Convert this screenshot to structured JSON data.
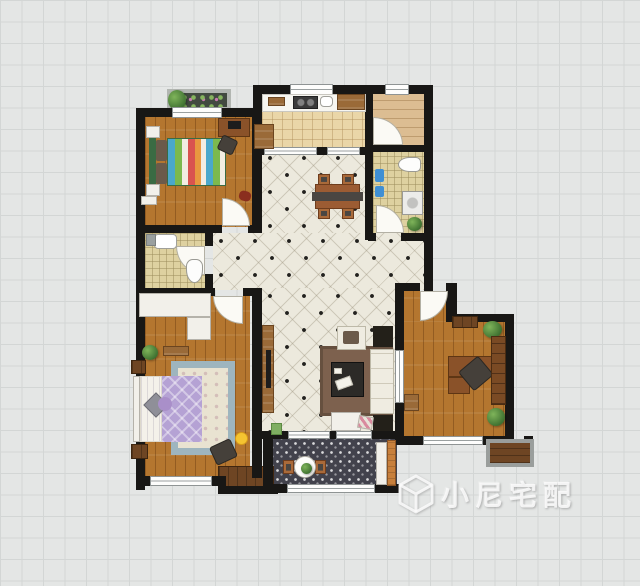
{
  "canvas": {
    "width": 640,
    "height": 586,
    "background": "#e4e6e5",
    "grid_color": "#d3d6d5"
  },
  "watermark": {
    "icon": "cube-logo-icon",
    "text": "小尼宅配"
  },
  "palette": {
    "wall": "#181715",
    "oak_floor": "#b4762f",
    "light_plank": "#dcbd92",
    "tile": "#ece9dd",
    "kitchen_tile": "#ead6a8",
    "mosaic": "#ded1a0",
    "balcony_tile": "#42424c",
    "purple_quilt": "#b5a2d4",
    "stripe_blue": "#4aa8cc",
    "stripe_green": "#7cb94e",
    "stripe_red": "#d9534f",
    "rug_blue": "#9eb5be",
    "rug_brown": "#7d614e",
    "smiley_yellow": "#f5c431",
    "towel_blue": "#3f8fd4",
    "door_orange": "#c8803c"
  },
  "elements": [
    {
      "n": "bedroom2-floor",
      "k": "floor-oak",
      "x": 145,
      "y": 116,
      "w": 108,
      "h": 111
    },
    {
      "n": "kitchen-floor",
      "k": "floor-kitchen",
      "x": 262,
      "y": 93,
      "w": 103,
      "h": 57
    },
    {
      "n": "foyer-floor",
      "k": "floor-oak-h",
      "x": 373,
      "y": 93,
      "w": 51,
      "h": 53
    },
    {
      "n": "bathroom1-floor",
      "k": "floor-mosaic",
      "x": 373,
      "y": 152,
      "w": 51,
      "h": 82
    },
    {
      "n": "dining-floor",
      "k": "floor-tile",
      "x": 262,
      "y": 150,
      "w": 103,
      "h": 85
    },
    {
      "n": "hallway-floor",
      "k": "floor-tile",
      "x": 213,
      "y": 233,
      "w": 211,
      "h": 57
    },
    {
      "n": "living-floor",
      "k": "floor-tile",
      "x": 262,
      "y": 288,
      "w": 133,
      "h": 146
    },
    {
      "n": "bathroom2-floor",
      "k": "floor-mosaic",
      "x": 145,
      "y": 233,
      "w": 60,
      "h": 57
    },
    {
      "n": "master-bedroom-floor",
      "k": "floor-oak",
      "x": 145,
      "y": 296,
      "w": 105,
      "h": 184
    },
    {
      "n": "study-floor-upper",
      "k": "floor-oak",
      "x": 403,
      "y": 291,
      "w": 46,
      "h": 32
    },
    {
      "n": "study-floor",
      "k": "floor-oak",
      "x": 403,
      "y": 322,
      "w": 102,
      "h": 116
    },
    {
      "n": "balcony-floor",
      "k": "floor-balcony",
      "x": 273,
      "y": 439,
      "w": 124,
      "h": 47
    },
    {
      "n": "bay-cabinet",
      "k": "cab-dark",
      "x": 218,
      "y": 466,
      "w": 56,
      "h": 24
    },
    {
      "n": "flower-box",
      "k": "planter",
      "x": 167,
      "y": 89,
      "w": 64,
      "h": 22
    },
    {
      "n": "plant",
      "k": "plant",
      "x": 168,
      "y": 90,
      "w": 18,
      "h": 20
    },
    {
      "n": "wall",
      "k": "wall",
      "x": 136,
      "y": 108,
      "w": 126,
      "h": 9
    },
    {
      "n": "wall",
      "k": "wall",
      "x": 253,
      "y": 85,
      "w": 9,
      "h": 70
    },
    {
      "n": "wall",
      "k": "wall",
      "x": 262,
      "y": 85,
      "w": 171,
      "h": 9
    },
    {
      "n": "wall",
      "k": "wall",
      "x": 136,
      "y": 108,
      "w": 9,
      "h": 382
    },
    {
      "n": "wall",
      "k": "wall",
      "x": 252,
      "y": 117,
      "w": 10,
      "h": 116
    },
    {
      "n": "wall",
      "k": "wall",
      "x": 365,
      "y": 94,
      "w": 8,
      "h": 146
    },
    {
      "n": "wall",
      "k": "wall",
      "x": 424,
      "y": 94,
      "w": 9,
      "h": 197
    },
    {
      "n": "wall",
      "k": "wall",
      "x": 368,
      "y": 145,
      "w": 57,
      "h": 7
    },
    {
      "n": "wall",
      "k": "wall",
      "x": 368,
      "y": 233,
      "w": 8,
      "h": 8
    },
    {
      "n": "wall",
      "k": "wall",
      "x": 401,
      "y": 233,
      "w": 24,
      "h": 8
    },
    {
      "n": "wall",
      "k": "wall",
      "x": 136,
      "y": 225,
      "w": 86,
      "h": 8
    },
    {
      "n": "wall",
      "k": "wall",
      "x": 248,
      "y": 225,
      "w": 14,
      "h": 8
    },
    {
      "n": "wall",
      "k": "wall",
      "x": 205,
      "y": 233,
      "w": 8,
      "h": 13
    },
    {
      "n": "wall",
      "k": "wall",
      "x": 205,
      "y": 274,
      "w": 8,
      "h": 17
    },
    {
      "n": "wall",
      "k": "wall",
      "x": 136,
      "y": 288,
      "w": 79,
      "h": 8
    },
    {
      "n": "wall",
      "k": "wall",
      "x": 243,
      "y": 288,
      "w": 19,
      "h": 8
    },
    {
      "n": "wall",
      "k": "wall",
      "x": 252,
      "y": 296,
      "w": 10,
      "h": 182
    },
    {
      "n": "wall",
      "k": "wall",
      "x": 136,
      "y": 476,
      "w": 90,
      "h": 10
    },
    {
      "n": "wall",
      "k": "wall",
      "x": 218,
      "y": 486,
      "w": 60,
      "h": 8
    },
    {
      "n": "wall",
      "k": "wall",
      "x": 262,
      "y": 431,
      "w": 135,
      "h": 8
    },
    {
      "n": "wall",
      "k": "wall",
      "x": 263,
      "y": 431,
      "w": 10,
      "h": 62
    },
    {
      "n": "wall",
      "k": "wall",
      "x": 273,
      "y": 484,
      "w": 126,
      "h": 9
    },
    {
      "n": "wall",
      "k": "wall",
      "x": 395,
      "y": 283,
      "w": 9,
      "h": 162
    },
    {
      "n": "wall",
      "k": "wall",
      "x": 404,
      "y": 283,
      "w": 16,
      "h": 8
    },
    {
      "n": "wall",
      "k": "wall",
      "x": 446,
      "y": 283,
      "w": 11,
      "h": 39
    },
    {
      "n": "wall",
      "k": "wall",
      "x": 453,
      "y": 314,
      "w": 58,
      "h": 8
    },
    {
      "n": "wall",
      "k": "wall",
      "x": 505,
      "y": 314,
      "w": 9,
      "h": 131
    },
    {
      "n": "wall",
      "k": "wall",
      "x": 395,
      "y": 436,
      "w": 119,
      "h": 9
    },
    {
      "n": "wall",
      "k": "wall",
      "x": 253,
      "y": 147,
      "w": 11,
      "h": 8
    },
    {
      "n": "wall",
      "k": "wall",
      "x": 317,
      "y": 147,
      "w": 10,
      "h": 8
    },
    {
      "n": "wall",
      "k": "wall",
      "x": 360,
      "y": 147,
      "w": 13,
      "h": 8
    },
    {
      "n": "wall",
      "k": "wall",
      "x": 486,
      "y": 436,
      "w": 9,
      "h": 10
    },
    {
      "n": "wall",
      "k": "wall",
      "x": 524,
      "y": 436,
      "w": 9,
      "h": 10
    },
    {
      "n": "window",
      "k": "win-h",
      "x": 172,
      "y": 107,
      "w": 50,
      "h": 11
    },
    {
      "n": "window",
      "k": "win-h",
      "x": 290,
      "y": 84,
      "w": 43,
      "h": 11
    },
    {
      "n": "window",
      "k": "win-h",
      "x": 385,
      "y": 84,
      "w": 24,
      "h": 11
    },
    {
      "n": "window",
      "k": "win-h",
      "x": 264,
      "y": 147,
      "w": 53,
      "h": 8
    },
    {
      "n": "window",
      "k": "win-h",
      "x": 327,
      "y": 147,
      "w": 33,
      "h": 8
    },
    {
      "n": "window",
      "k": "win-h",
      "x": 150,
      "y": 476,
      "w": 62,
      "h": 10
    },
    {
      "n": "window",
      "k": "win-h",
      "x": 287,
      "y": 484,
      "w": 88,
      "h": 9
    },
    {
      "n": "window",
      "k": "win-h",
      "x": 288,
      "y": 431,
      "w": 42,
      "h": 8
    },
    {
      "n": "window",
      "k": "win-h",
      "x": 336,
      "y": 431,
      "w": 36,
      "h": 8
    },
    {
      "n": "window",
      "k": "win-v",
      "x": 395,
      "y": 350,
      "w": 9,
      "h": 53
    },
    {
      "n": "window",
      "k": "win-h",
      "x": 423,
      "y": 436,
      "w": 60,
      "h": 9
    },
    {
      "n": "door-swing",
      "k": "arc-ne",
      "x": 222,
      "y": 198,
      "w": 28,
      "h": 28
    },
    {
      "n": "door-swing",
      "k": "arc-sw",
      "x": 176,
      "y": 246,
      "w": 29,
      "h": 29
    },
    {
      "n": "door-swing",
      "k": "arc-sw",
      "x": 213,
      "y": 296,
      "w": 30,
      "h": 28
    },
    {
      "n": "door-swing",
      "k": "arc-ne",
      "x": 373,
      "y": 117,
      "w": 30,
      "h": 28
    },
    {
      "n": "door-swing",
      "k": "arc-ne",
      "x": 376,
      "y": 205,
      "w": 28,
      "h": 28
    },
    {
      "n": "door-swing",
      "k": "arc-se",
      "x": 420,
      "y": 291,
      "w": 28,
      "h": 30
    },
    {
      "n": "kitchen-counter",
      "k": "counter",
      "x": 262,
      "y": 94,
      "w": 104,
      "h": 18
    },
    {
      "n": "cutting-board",
      "k": "cab-wood",
      "x": 268,
      "y": 97,
      "w": 17,
      "h": 9
    },
    {
      "n": "stove",
      "k": "appl-dark",
      "x": 293,
      "y": 96,
      "w": 25,
      "h": 13
    },
    {
      "n": "kitchen-sink",
      "k": "sink",
      "x": 320,
      "y": 96,
      "w": 13,
      "h": 11
    },
    {
      "n": "kitchen-cabinet",
      "k": "cab-wood",
      "x": 337,
      "y": 94,
      "w": 28,
      "h": 16
    },
    {
      "n": "fridge",
      "k": "cab-wood",
      "x": 254,
      "y": 124,
      "w": 20,
      "h": 25
    },
    {
      "n": "toilet",
      "k": "toilet",
      "x": 398,
      "y": 157,
      "w": 23,
      "h": 15
    },
    {
      "n": "towel",
      "k": "towel",
      "x": 375,
      "y": 169,
      "w": 9,
      "h": 13
    },
    {
      "n": "towel",
      "k": "towel",
      "x": 375,
      "y": 186,
      "w": 9,
      "h": 11
    },
    {
      "n": "washing-machine",
      "k": "washer",
      "x": 402,
      "y": 191,
      "w": 21,
      "h": 24
    },
    {
      "n": "plant",
      "k": "plant",
      "x": 407,
      "y": 217,
      "w": 15,
      "h": 14
    },
    {
      "n": "dining-chair",
      "k": "chair-wood",
      "x": 318,
      "y": 174,
      "w": 12,
      "h": 11
    },
    {
      "n": "dining-chair",
      "k": "chair-wood",
      "x": 342,
      "y": 174,
      "w": 12,
      "h": 11
    },
    {
      "n": "dining-chair",
      "k": "chair-wood",
      "x": 318,
      "y": 208,
      "w": 12,
      "h": 11
    },
    {
      "n": "dining-chair",
      "k": "chair-wood",
      "x": 342,
      "y": 208,
      "w": 12,
      "h": 11
    },
    {
      "n": "dining-table",
      "k": "table-wood",
      "x": 315,
      "y": 184,
      "w": 45,
      "h": 25
    },
    {
      "n": "table-runner",
      "k": "runner",
      "x": 312,
      "y": 192,
      "w": 51,
      "h": 9
    },
    {
      "n": "bathroom-sink",
      "k": "sink",
      "x": 154,
      "y": 234,
      "w": 23,
      "h": 15
    },
    {
      "n": "toilet",
      "k": "toilet-v",
      "x": 186,
      "y": 259,
      "w": 17,
      "h": 24
    },
    {
      "n": "shower-fixture",
      "k": "gray-box",
      "x": 146,
      "y": 234,
      "w": 10,
      "h": 12
    },
    {
      "n": "wardrobe",
      "k": "white-box",
      "x": 139,
      "y": 293,
      "w": 72,
      "h": 24
    },
    {
      "n": "wardrobe",
      "k": "white-box",
      "x": 187,
      "y": 317,
      "w": 24,
      "h": 23
    },
    {
      "n": "bench",
      "k": "cab-wood",
      "x": 163,
      "y": 346,
      "w": 26,
      "h": 10
    },
    {
      "n": "plant",
      "k": "plant",
      "x": 142,
      "y": 345,
      "w": 16,
      "h": 15
    },
    {
      "n": "nightstand",
      "k": "cab-dark",
      "x": 131,
      "y": 360,
      "w": 15,
      "h": 14
    },
    {
      "n": "nightstand",
      "k": "cab-dark",
      "x": 131,
      "y": 444,
      "w": 17,
      "h": 15
    },
    {
      "n": "area-rug",
      "k": "rug-floral",
      "x": 171,
      "y": 361,
      "w": 64,
      "h": 94
    },
    {
      "n": "bed-headboard",
      "k": "white-box",
      "x": 133,
      "y": 376,
      "w": 7,
      "h": 66
    },
    {
      "n": "bed-sheet",
      "k": "sheet",
      "x": 140,
      "y": 376,
      "w": 22,
      "h": 66
    },
    {
      "n": "bed-quilt",
      "k": "quilt-purple",
      "x": 162,
      "y": 376,
      "w": 40,
      "h": 66
    },
    {
      "n": "pillow",
      "k": "pillow-gray",
      "x": 147,
      "y": 396,
      "w": 18,
      "h": 18,
      "r": 45
    },
    {
      "n": "pillow",
      "k": "pillow-purple",
      "x": 158,
      "y": 397,
      "w": 14,
      "h": 14
    },
    {
      "n": "smiley-rug",
      "k": "smiley",
      "x": 235,
      "y": 432,
      "w": 13,
      "h": 13
    },
    {
      "n": "armchair",
      "k": "chair-dark",
      "x": 212,
      "y": 442,
      "w": 23,
      "h": 20,
      "r": -25
    },
    {
      "n": "tv-cabinet",
      "k": "cab-wood",
      "x": 262,
      "y": 325,
      "w": 12,
      "h": 88
    },
    {
      "n": "tv",
      "k": "tv",
      "x": 266,
      "y": 350,
      "w": 5,
      "h": 38
    },
    {
      "n": "living-rug",
      "k": "rug-brown",
      "x": 320,
      "y": 346,
      "w": 73,
      "h": 70
    },
    {
      "n": "coffee-table",
      "k": "ctable",
      "x": 331,
      "y": 362,
      "w": 33,
      "h": 35
    },
    {
      "n": "magazine",
      "k": "paper",
      "x": 336,
      "y": 378,
      "w": 16,
      "h": 10,
      "r": -20
    },
    {
      "n": "remote",
      "k": "paper",
      "x": 334,
      "y": 368,
      "w": 8,
      "h": 6
    },
    {
      "n": "armchair",
      "k": "armchair",
      "x": 337,
      "y": 326,
      "w": 29,
      "h": 24
    },
    {
      "n": "armchair-cushion",
      "k": "cushion",
      "x": 343,
      "y": 331,
      "w": 16,
      "h": 13
    },
    {
      "n": "sofa",
      "k": "sofa",
      "x": 370,
      "y": 349,
      "w": 24,
      "h": 65
    },
    {
      "n": "side-table",
      "k": "sidetable",
      "x": 373,
      "y": 326,
      "w": 20,
      "h": 21
    },
    {
      "n": "side-table",
      "k": "sidetable",
      "x": 373,
      "y": 415,
      "w": 20,
      "h": 16
    },
    {
      "n": "console-table",
      "k": "white-box",
      "x": 331,
      "y": 412,
      "w": 30,
      "h": 19
    },
    {
      "n": "door-mat",
      "k": "mat-color",
      "x": 358,
      "y": 416,
      "w": 15,
      "h": 13,
      "r": 10
    },
    {
      "n": "door-mat",
      "k": "mat-green",
      "x": 271,
      "y": 423,
      "w": 11,
      "h": 12
    },
    {
      "n": "balcony-chair",
      "k": "chair-wood",
      "x": 283,
      "y": 460,
      "w": 11,
      "h": 14
    },
    {
      "n": "balcony-chair",
      "k": "chair-wood",
      "x": 315,
      "y": 460,
      "w": 11,
      "h": 14
    },
    {
      "n": "balcony-table",
      "k": "btable",
      "x": 294,
      "y": 456,
      "w": 22,
      "h": 22
    },
    {
      "n": "plant",
      "k": "plant",
      "x": 301,
      "y": 463,
      "w": 11,
      "h": 11
    },
    {
      "n": "balcony-cabinet",
      "k": "white-box",
      "x": 376,
      "y": 442,
      "w": 11,
      "h": 43
    },
    {
      "n": "balcony-door",
      "k": "door-orange",
      "x": 387,
      "y": 440,
      "w": 9,
      "h": 46
    },
    {
      "n": "wall-shelf",
      "k": "cab-dark",
      "x": 452,
      "y": 316,
      "w": 26,
      "h": 12
    },
    {
      "n": "plant",
      "k": "plant",
      "x": 483,
      "y": 321,
      "w": 19,
      "h": 17
    },
    {
      "n": "desk",
      "k": "desk-wood",
      "x": 448,
      "y": 356,
      "w": 49,
      "h": 21
    },
    {
      "n": "desk",
      "k": "desk-wood",
      "x": 448,
      "y": 377,
      "w": 22,
      "h": 17
    },
    {
      "n": "desk-chair",
      "k": "chair-dark",
      "x": 463,
      "y": 361,
      "w": 26,
      "h": 25,
      "r": -40
    },
    {
      "n": "bookshelf",
      "k": "bookshelf",
      "x": 491,
      "y": 336,
      "w": 15,
      "h": 69
    },
    {
      "n": "plant",
      "k": "plant",
      "x": 487,
      "y": 408,
      "w": 18,
      "h": 18
    },
    {
      "n": "cabinet",
      "k": "cab-wood",
      "x": 404,
      "y": 394,
      "w": 15,
      "h": 17
    },
    {
      "n": "flower-ledge",
      "k": "ledge",
      "x": 486,
      "y": 439,
      "w": 48,
      "h": 28
    },
    {
      "n": "bed-headboard",
      "k": "headboard-green",
      "x": 149,
      "y": 138,
      "w": 7,
      "h": 48
    },
    {
      "n": "pillow",
      "k": "cushion",
      "x": 156,
      "y": 140,
      "w": 11,
      "h": 21
    },
    {
      "n": "pillow",
      "k": "cushion",
      "x": 156,
      "y": 163,
      "w": 11,
      "h": 21
    },
    {
      "n": "bed-quilt",
      "k": "quilt-stripes",
      "x": 167,
      "y": 138,
      "w": 59,
      "h": 48
    },
    {
      "n": "nightstand",
      "k": "white-box",
      "x": 146,
      "y": 126,
      "w": 14,
      "h": 12
    },
    {
      "n": "nightstand",
      "k": "white-box",
      "x": 146,
      "y": 184,
      "w": 14,
      "h": 12
    },
    {
      "n": "desk",
      "k": "desk-wood",
      "x": 218,
      "y": 118,
      "w": 32,
      "h": 19
    },
    {
      "n": "monitor",
      "k": "tv",
      "x": 228,
      "y": 121,
      "w": 13,
      "h": 8
    },
    {
      "n": "desk-chair",
      "k": "chair-dark",
      "x": 219,
      "y": 137,
      "w": 17,
      "h": 16,
      "r": 25
    },
    {
      "n": "beanbag",
      "k": "beanbag",
      "x": 239,
      "y": 191,
      "w": 12,
      "h": 10,
      "r": 15
    },
    {
      "n": "dresser",
      "k": "white-box",
      "x": 141,
      "y": 196,
      "w": 16,
      "h": 9
    }
  ]
}
